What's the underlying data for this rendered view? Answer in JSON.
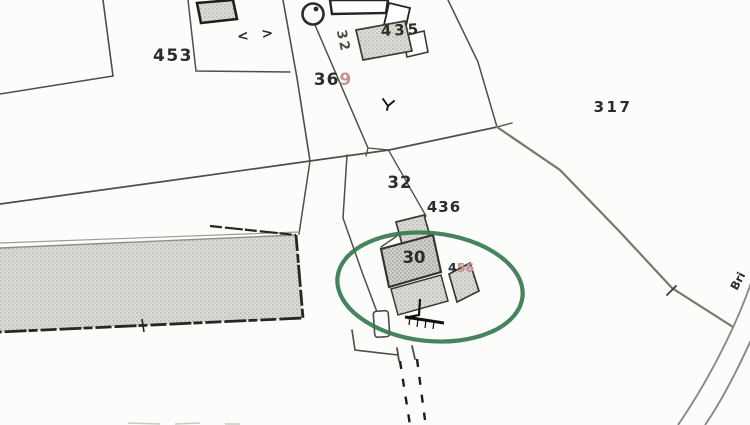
{
  "map_labels": {
    "p453": "453",
    "p369_dark": "36",
    "p369_faded": "9",
    "p435": "435",
    "lane32": "32",
    "p317": "317",
    "p32": "32",
    "p436": "436",
    "h30": "30",
    "h456_dark": "4",
    "h456_faded": "56",
    "gates": "< >",
    "road_partial": "Bri"
  },
  "symbols": {
    "well": "circle-with-dot",
    "tree_marker": "three-prong-tick",
    "gate": "angle-chevrons",
    "footpath": "double-dashed-line"
  },
  "colors": {
    "ink": "#2c2c2a",
    "faded_red_ink": "#c49490",
    "highlight_green": "#357a4e",
    "building_fill": "#dad8d3",
    "road_gray": "#8a8986",
    "background": "#fcfcfa"
  }
}
